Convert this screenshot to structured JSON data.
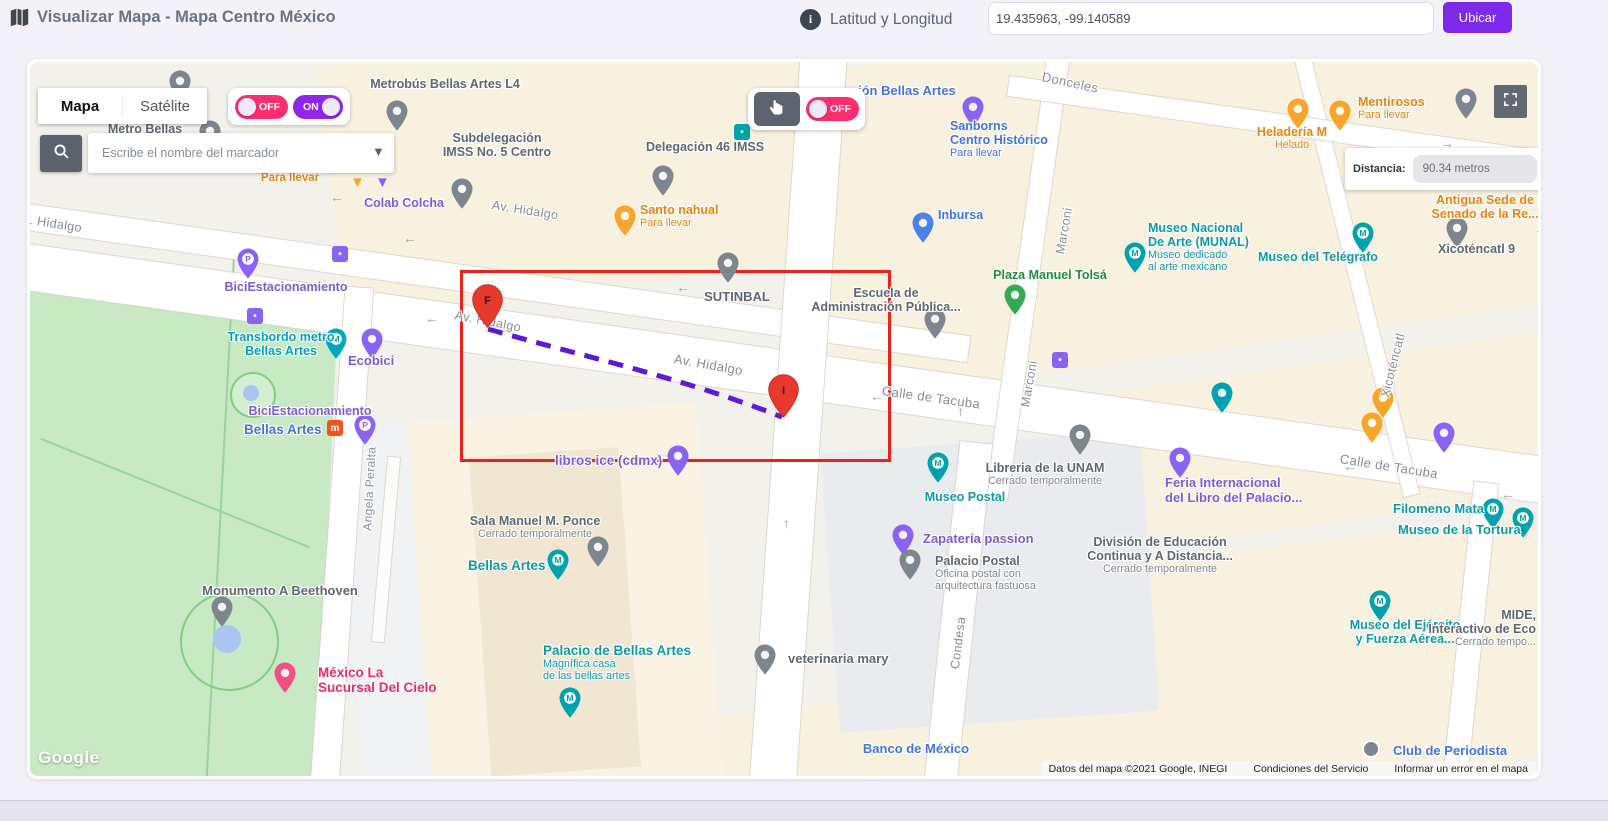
{
  "header": {
    "title": "Visualizar Mapa - Mapa Centro México",
    "coords_label": "Latitud y Longitud",
    "coords_value": "19.435963, -99.140589",
    "locate_button": "Ubicar"
  },
  "controls": {
    "map_tab": "Mapa",
    "satellite_tab": "Satélite",
    "toggle_off": "OFF",
    "toggle_on": "ON",
    "drag_toggle_off": "OFF",
    "search_placeholder": "Escribe el nombre del marcador",
    "distance_label": "Distancia:",
    "distance_value": "90.34 metros"
  },
  "selection": {
    "rect": {
      "x": 430,
      "y": 208,
      "w": 425,
      "h": 186
    },
    "start": {
      "label": "F",
      "x": 457,
      "y": 222
    },
    "end": {
      "label": "I",
      "x": 753,
      "y": 312
    },
    "path_d": "M 458 267 C 555 295 650 315 752 355"
  },
  "attribution": {
    "logo": "Google",
    "map_data": "Datos del mapa ©2021 Google, INEGI",
    "terms": "Condiciones del Servicio",
    "report": "Informar un error en el mapa"
  },
  "colors": {
    "accent_purple": "#7d2ae8",
    "toggle_pink": "#fd2e6e",
    "toggle_purple": "#9125ea",
    "route_purple": "#5f17d9",
    "selection_red": "#e8231a",
    "marker_red": "#e8392e",
    "label_colors": {
      "teal": "#0e9aa2",
      "cyan": "#00a0bb",
      "blue": "#4273de",
      "purple": "#7a5bd8",
      "orange": "#e8830c",
      "green": "#1f8f3f",
      "pink": "#e92a66",
      "gray": "#5f6770",
      "street": "#868d96"
    },
    "pin_colors": {
      "teal": "#00a2ae",
      "cyan": "#00a5c0",
      "blue": "#4b80ee",
      "purple": "#8a63f2",
      "orange": "#f6a62a",
      "green": "#34a853",
      "pink": "#f14f86",
      "gray": "#7d858f",
      "metro": "#f4511e",
      "red": "#e8392e"
    }
  },
  "map_labels": [
    {
      "ls": [
        "v. Hidalgo"
      ],
      "c": "street",
      "x": -6,
      "y": 150,
      "r": 9
    },
    {
      "ls": [
        "Av. Hidalgo"
      ],
      "c": "street",
      "x": 462,
      "y": 136,
      "r": 9
    },
    {
      "ls": [
        "Av. Hidalgo"
      ],
      "c": "street",
      "x": 425,
      "y": 246,
      "r": 11
    },
    {
      "ls": [
        "Av. Hidalgo"
      ],
      "c": "street",
      "x": 644,
      "y": 290,
      "r": 10,
      "fs": 13
    },
    {
      "ls": [
        "Calle de Tacuba"
      ],
      "c": "street",
      "x": 852,
      "y": 322,
      "r": 8,
      "fs": 13
    },
    {
      "ls": [
        "Calle de Tacuba"
      ],
      "c": "street",
      "x": 1310,
      "y": 390,
      "r": 9,
      "fs": 13
    },
    {
      "ls": [
        "Donceles"
      ],
      "c": "street",
      "x": 1012,
      "y": 8,
      "r": 12,
      "fs": 13
    },
    {
      "ls": [
        "Marconi"
      ],
      "c": "street",
      "x": 1030,
      "y": 185,
      "r": -80
    },
    {
      "ls": [
        "Marconi"
      ],
      "c": "street",
      "x": 995,
      "y": 338,
      "r": -80
    },
    {
      "ls": [
        "Xicoténcatl"
      ],
      "c": "street",
      "x": 1355,
      "y": 328,
      "r": -76
    },
    {
      "ls": [
        "Xicoténcatl"
      ],
      "c": "street",
      "x": 1512,
      "y": 165,
      "r": -80,
      "fs": 12
    },
    {
      "ls": [
        "Condesa"
      ],
      "c": "street",
      "x": 925,
      "y": 600,
      "r": -83
    },
    {
      "ls": [
        "Angela Peralta"
      ],
      "c": "street",
      "x": 338,
      "y": 462,
      "r": -87,
      "fs": 12
    },
    {
      "ls": [
        "Metro Bellas"
      ],
      "c": "gray",
      "x": 115,
      "y": 60,
      "a": "c"
    },
    {
      "ls": [
        "Metrobús Bellas Artes L4"
      ],
      "c": "gray",
      "x": 415,
      "y": 15,
      "a": "c"
    },
    {
      "ls": [
        "Subdelegación",
        "IMSS No. 5 Centro"
      ],
      "c": "gray",
      "x": 467,
      "y": 69,
      "a": "c"
    },
    {
      "ls": [
        "Delegación 46 IMSS"
      ],
      "c": "gray",
      "x": 675,
      "y": 78,
      "a": "c"
    },
    {
      "ls": [
        "Santo nahual"
      ],
      "sub": [
        "Para llevar"
      ],
      "sc": "same",
      "c": "orange",
      "x": 610,
      "y": 141,
      "a": "l"
    },
    {
      "ls": [
        "Colab Colcha"
      ],
      "c": "purple",
      "x": 374,
      "y": 134,
      "a": "c"
    },
    {
      "ls": [
        "Para llevar"
      ],
      "c": "orange",
      "x": 260,
      "y": 110,
      "a": "c",
      "fs": 11.5
    },
    {
      "ls": [
        "ión Bellas Artes"
      ],
      "c": "blue",
      "x": 828,
      "y": 22,
      "a": "l",
      "fs": 13
    },
    {
      "ls": [
        "Sanborns",
        "Centro Histórico"
      ],
      "sub": [
        "Para llevar"
      ],
      "sc": "same",
      "c": "blue",
      "x": 920,
      "y": 57,
      "a": "l"
    },
    {
      "ls": [
        "Heladería M"
      ],
      "sub": [
        "Helado"
      ],
      "sc": "same",
      "c": "orange",
      "x": 1262,
      "y": 63,
      "a": "c"
    },
    {
      "ls": [
        "Mentirosos"
      ],
      "sub": [
        "Para llevar"
      ],
      "sc": "same",
      "c": "orange",
      "x": 1328,
      "y": 33,
      "a": "l"
    },
    {
      "ls": [
        "Antigua Sede de",
        "Senado de la Re..."
      ],
      "c": "orange",
      "x": 1455,
      "y": 131,
      "a": "c"
    },
    {
      "ls": [
        "Xicoténcatl 9"
      ],
      "c": "gray",
      "x": 1408,
      "y": 180,
      "a": "l"
    },
    {
      "ls": [
        "Museo Nacional",
        "De Arte (MUNAL)"
      ],
      "sub": [
        "Museo dedicado",
        "al arte mexicano"
      ],
      "sc": "same",
      "c": "teal",
      "x": 1118,
      "y": 159,
      "a": "l"
    },
    {
      "ls": [
        "Museo del Telégrafo"
      ],
      "c": "teal",
      "x": 1228,
      "y": 188,
      "a": "l"
    },
    {
      "ls": [
        "Plaza Manuel Tolsá"
      ],
      "c": "green",
      "x": 1020,
      "y": 206,
      "a": "c"
    },
    {
      "ls": [
        "Escuela de",
        "Administración Pública..."
      ],
      "c": "gray",
      "x": 856,
      "y": 224,
      "a": "c"
    },
    {
      "ls": [
        "Inbursa"
      ],
      "c": "blue",
      "x": 908,
      "y": 146,
      "a": "l"
    },
    {
      "ls": [
        "SUTINBAL"
      ],
      "c": "gray",
      "x": 707,
      "y": 228,
      "a": "c",
      "fs": 13
    },
    {
      "ls": [
        "Libreria de la UNAM"
      ],
      "sub": [
        "Cerrado temporalmente"
      ],
      "sc": "gray",
      "c": "gray",
      "x": 1015,
      "y": 399,
      "a": "c"
    },
    {
      "ls": [
        "Museo Postal"
      ],
      "c": "teal",
      "x": 935,
      "y": 428,
      "a": "c"
    },
    {
      "ls": [
        "Zapatería passion"
      ],
      "c": "purple",
      "x": 893,
      "y": 470,
      "a": "l",
      "fs": 13
    },
    {
      "ls": [
        "Palacio Postal"
      ],
      "sub": [
        "Oficina postal con",
        "arquitectura fastuosa"
      ],
      "sc": "gray",
      "c": "gray",
      "x": 905,
      "y": 492,
      "a": "l"
    },
    {
      "ls": [
        "División de Educación",
        "Continua y A Distancia..."
      ],
      "sub": [
        "Cerrado temporalmente"
      ],
      "sc": "gray",
      "c": "gray",
      "x": 1130,
      "y": 473,
      "a": "c"
    },
    {
      "ls": [
        "Feria Internacional",
        "del Libro del Palacio..."
      ],
      "c": "purple",
      "x": 1135,
      "y": 414,
      "a": "l",
      "fs": 13
    },
    {
      "ls": [
        "Filomeno Mata"
      ],
      "c": "teal",
      "x": 1363,
      "y": 440,
      "a": "l",
      "fs": 13
    },
    {
      "ls": [
        "Museo de la Tortura"
      ],
      "c": "teal",
      "x": 1368,
      "y": 461,
      "a": "l",
      "fs": 13
    },
    {
      "ls": [
        "Museo del Ejército",
        "y Fuerza Aérea..."
      ],
      "c": "teal",
      "x": 1375,
      "y": 556,
      "a": "c"
    },
    {
      "ls": [
        "MIDE,",
        "Interactivo de Eco"
      ],
      "sub": [
        "Cerrado tempo..."
      ],
      "sc": "gray",
      "c": "gray",
      "x": 1506,
      "y": 546,
      "a": "r"
    },
    {
      "ls": [
        "veterinaria mary"
      ],
      "c": "gray",
      "x": 758,
      "y": 590,
      "a": "l",
      "fs": 13
    },
    {
      "ls": [
        "Banco de México"
      ],
      "c": "blue",
      "x": 886,
      "y": 680,
      "a": "c",
      "fs": 13
    },
    {
      "ls": [
        "Club de Periodista"
      ],
      "c": "blue",
      "x": 1363,
      "y": 682,
      "a": "l",
      "fs": 13
    },
    {
      "ls": [
        "Monumento A Beethoven"
      ],
      "c": "gray",
      "x": 250,
      "y": 522,
      "a": "c",
      "fs": 13
    },
    {
      "ls": [
        "México La",
        "Sucursal Del Cielo"
      ],
      "c": "pink",
      "x": 288,
      "y": 603,
      "a": "l",
      "fs": 13.5
    },
    {
      "ls": [
        "Sala Manuel M. Ponce"
      ],
      "sub": [
        "Cerrado temporalmente"
      ],
      "sc": "gray",
      "c": "gray",
      "x": 505,
      "y": 452,
      "a": "c"
    },
    {
      "ls": [
        "Bellas Artes"
      ],
      "c": "teal",
      "x": 438,
      "y": 496,
      "a": "l",
      "fs": 13.5
    },
    {
      "ls": [
        "Palacio de Bellas Artes"
      ],
      "sub": [
        "Magnífica casa",
        "de las bellas artes"
      ],
      "sc": "same",
      "c": "teal",
      "x": 513,
      "y": 581,
      "a": "l",
      "fs": 13.5
    },
    {
      "ls": [
        "libros ice (cdmx)"
      ],
      "c": "purple",
      "x": 525,
      "y": 391,
      "a": "l",
      "fs": 13.5
    },
    {
      "ls": [
        "Bellas Artes"
      ],
      "c": "blue",
      "x": 214,
      "y": 360,
      "a": "l",
      "fs": 13.5
    },
    {
      "ls": [
        "BiciEstacionamiento"
      ],
      "c": "purple",
      "x": 280,
      "y": 342,
      "a": "c"
    },
    {
      "ls": [
        "BiciEstacionamiento"
      ],
      "c": "purple",
      "x": 256,
      "y": 218,
      "a": "c"
    },
    {
      "ls": [
        "Transbordo metro",
        "Bellas Artes"
      ],
      "c": "cyan",
      "x": 251,
      "y": 268,
      "a": "c"
    },
    {
      "ls": [
        "Ecobici"
      ],
      "c": "purple",
      "x": 318,
      "y": 292,
      "a": "l",
      "fs": 13
    }
  ],
  "map_pins": [
    {
      "x": 150,
      "y": 8,
      "c": "gray"
    },
    {
      "x": 180,
      "y": 58,
      "c": "gray"
    },
    {
      "x": 367,
      "y": 38,
      "c": "gray"
    },
    {
      "x": 432,
      "y": 116,
      "c": "gray"
    },
    {
      "x": 633,
      "y": 103,
      "c": "gray"
    },
    {
      "x": 595,
      "y": 143,
      "c": "orange"
    },
    {
      "x": 327,
      "y": 112,
      "c": "orange",
      "k": "t"
    },
    {
      "x": 352,
      "y": 112,
      "c": "purple",
      "k": "t"
    },
    {
      "x": 943,
      "y": 34,
      "c": "purple"
    },
    {
      "x": 712,
      "y": 62,
      "c": "teal",
      "k": "q"
    },
    {
      "x": 1268,
      "y": 36,
      "c": "orange"
    },
    {
      "x": 1310,
      "y": 38,
      "c": "orange"
    },
    {
      "x": 1436,
      "y": 26,
      "c": "gray"
    },
    {
      "x": 893,
      "y": 150,
      "c": "blue"
    },
    {
      "x": 905,
      "y": 246,
      "c": "gray"
    },
    {
      "x": 698,
      "y": 190,
      "c": "gray"
    },
    {
      "x": 985,
      "y": 222,
      "c": "green"
    },
    {
      "x": 1105,
      "y": 180,
      "c": "teal",
      "g": "M"
    },
    {
      "x": 1333,
      "y": 160,
      "c": "teal",
      "g": "M"
    },
    {
      "x": 1427,
      "y": 155,
      "c": "gray"
    },
    {
      "x": 1192,
      "y": 320,
      "c": "teal"
    },
    {
      "x": 1353,
      "y": 325,
      "c": "orange"
    },
    {
      "x": 1414,
      "y": 360,
      "c": "purple"
    },
    {
      "x": 1342,
      "y": 350,
      "c": "orange"
    },
    {
      "x": 1050,
      "y": 362,
      "c": "gray"
    },
    {
      "x": 908,
      "y": 390,
      "c": "teal",
      "g": "M"
    },
    {
      "x": 873,
      "y": 462,
      "c": "purple"
    },
    {
      "x": 880,
      "y": 487,
      "c": "gray"
    },
    {
      "x": 1150,
      "y": 385,
      "c": "purple"
    },
    {
      "x": 1463,
      "y": 436,
      "c": "teal",
      "g": "M"
    },
    {
      "x": 1493,
      "y": 445,
      "c": "teal",
      "g": "M"
    },
    {
      "x": 1350,
      "y": 528,
      "c": "teal",
      "g": "M"
    },
    {
      "x": 735,
      "y": 582,
      "c": "gray"
    },
    {
      "x": 192,
      "y": 534,
      "c": "gray"
    },
    {
      "x": 255,
      "y": 600,
      "c": "pink"
    },
    {
      "x": 528,
      "y": 487,
      "c": "teal",
      "g": "M"
    },
    {
      "x": 568,
      "y": 474,
      "c": "gray"
    },
    {
      "x": 540,
      "y": 625,
      "c": "teal",
      "g": "M"
    },
    {
      "x": 648,
      "y": 383,
      "c": "purple"
    },
    {
      "x": 305,
      "y": 358,
      "c": "metro",
      "k": "q",
      "g": "m"
    },
    {
      "x": 335,
      "y": 352,
      "c": "purple",
      "g": "P"
    },
    {
      "x": 218,
      "y": 186,
      "c": "purple",
      "g": "P"
    },
    {
      "x": 225,
      "y": 246,
      "c": "purple",
      "k": "q"
    },
    {
      "x": 306,
      "y": 266,
      "c": "cyan",
      "g": "M"
    },
    {
      "x": 342,
      "y": 266,
      "c": "purple"
    },
    {
      "x": 310,
      "y": 184,
      "c": "purple",
      "k": "q"
    },
    {
      "x": 1030,
      "y": 290,
      "c": "purple",
      "k": "q"
    },
    {
      "x": 1340,
      "y": 678,
      "c": "gray",
      "k": "d"
    }
  ],
  "map_arrows": [
    {
      "x": 300,
      "y": 127,
      "g": "←"
    },
    {
      "x": 373,
      "y": 168,
      "g": "←"
    },
    {
      "x": 646,
      "y": 217,
      "g": "←"
    },
    {
      "x": 395,
      "y": 248,
      "g": "←"
    },
    {
      "x": 840,
      "y": 326,
      "g": "←"
    },
    {
      "x": 1313,
      "y": 396,
      "g": "←"
    },
    {
      "x": 1471,
      "y": 424,
      "g": "←"
    },
    {
      "x": 1410,
      "y": 73,
      "g": "→"
    },
    {
      "x": 753,
      "y": 453,
      "g": "↑"
    },
    {
      "x": 927,
      "y": 341,
      "g": "↑"
    }
  ]
}
